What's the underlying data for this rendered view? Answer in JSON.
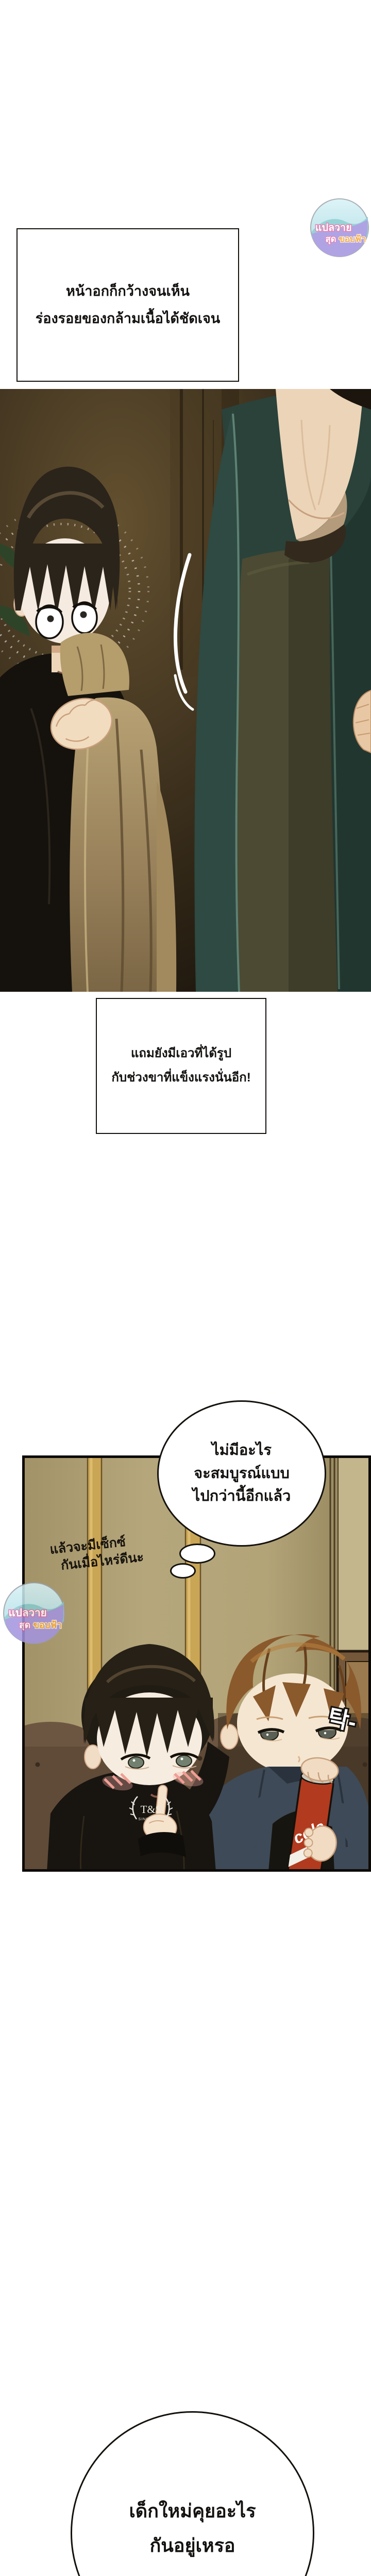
{
  "narration": {
    "box1": {
      "line1": "หน้าอกก็กว้างจนเห็น",
      "line2": "ร่องรอยของกล้ามเนื้อได้ชัดเจน"
    },
    "box2": {
      "line1": "แถมยังมีเอวที่ได้รูป",
      "line2": "กับช่วงขาที่แข็งแรงนั่นอีก!"
    }
  },
  "thought_bubble": {
    "line1": "ไม่มีอะไร",
    "line2": "จะสมบูรณ์แบบ",
    "line3": "ไปกว่านี้อีกแล้ว"
  },
  "note": {
    "line1": "แล้วจะมีเซ็กซ์",
    "line2": "กันเมื่อไหร่ดีนะ"
  },
  "bottom_bubble": {
    "line1": "เด็กใหม่คุยอะไร",
    "line2": "กันอยู่เหรอ"
  },
  "sfx": {
    "text": "탁-"
  },
  "watermark": {
    "line1": "แปลวาย",
    "line2_part1": "สุด",
    "line2_part2": "ขอบฟ้า"
  },
  "props": {
    "hoodie_logo_line1": "T&S",
    "hoodie_logo_line2": "SINCE 1991",
    "can_label": "cola"
  },
  "palette": {
    "page_bg": "#ffffff",
    "ink": "#14110d",
    "panel1_bg_brown": "#3f3220",
    "cloth_tan": "#a8905f",
    "jacket_teal": "#2e4a42",
    "shirt_olive": "#4c4a33",
    "skin": "#f2dcc0",
    "panel2_wall_tan": "#b3a478",
    "curtain_gold": "#c9a556",
    "sofa_brown": "#5f4b38",
    "boy_hair_brown": "#8a592c",
    "hoodie_black": "#181410",
    "jacket_slate": "#3e4a57",
    "cola_red": "#b23a1e",
    "watermark_pink": "#e06aa8",
    "watermark_orange": "#f5a02c",
    "watermark_purple": "#a393e0"
  }
}
